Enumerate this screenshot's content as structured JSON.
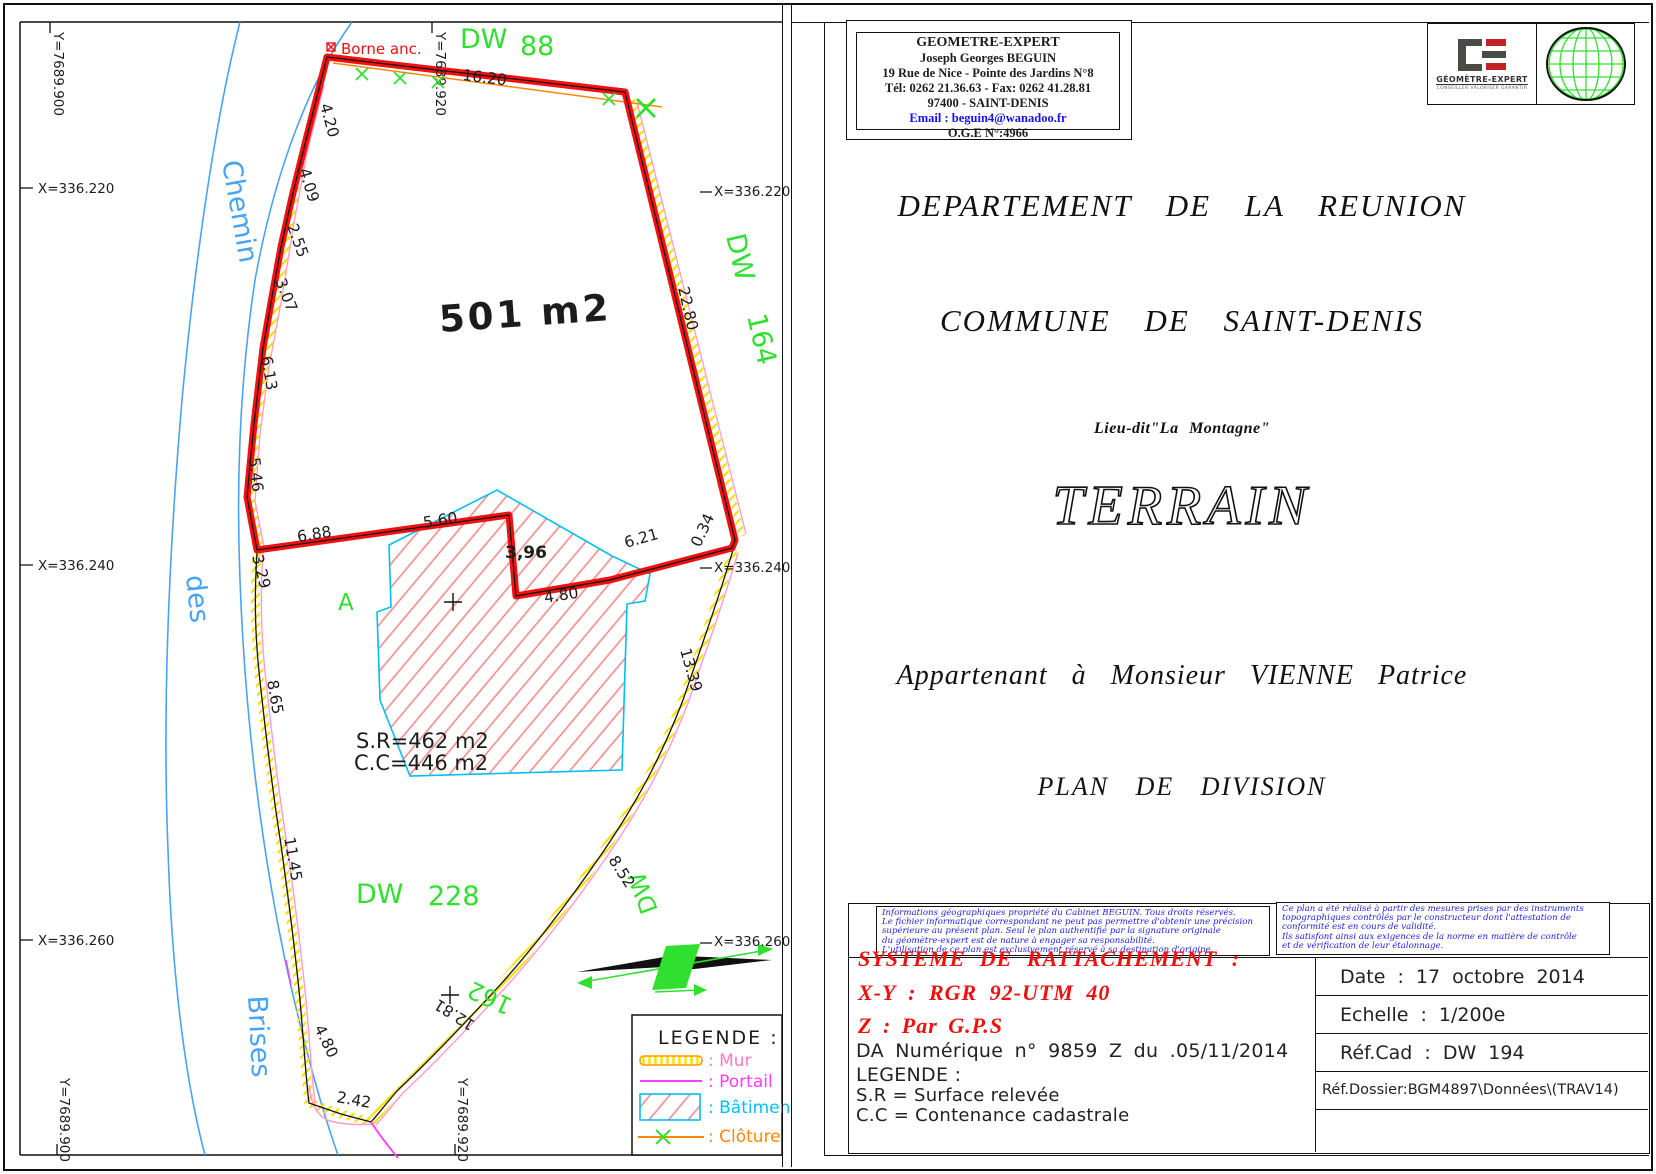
{
  "header_box": {
    "lines": [
      "GEOMETRE-EXPERT",
      "Joseph Georges BEGUIN",
      "19 Rue de Nice -  Pointe des Jardins N°8",
      "Tél: 0262 21.36.63 - Fax: 0262 41.28.81",
      "97400 - SAINT-DENIS"
    ],
    "email": "Email : beguin4@wanadoo.fr",
    "oge": "O.G.E N°:4966"
  },
  "logo": {
    "brand": "GÉOMÈTRE-EXPERT",
    "tagline": "CONSEILLER VALORISER GARANTIR"
  },
  "titles": {
    "departement": "DEPARTEMENT DE LA REUNION",
    "commune": "COMMUNE DE SAINT-DENIS",
    "lieu_dit": "Lieu-dit\"La Montagne\"",
    "terrain": "TERRAIN",
    "owner": "Appartenant à Monsieur VIENNE Patrice",
    "plan": "PLAN DE DIVISION"
  },
  "disclaimers": {
    "left": [
      "Informations géographiques propriété du Cabinet BEGUIN. Tous droits réservés.",
      "Le fichier informatique correspondant ne peut pas permettre d'obtenir une précision",
      "supérieure au présent plan. Seul le plan authentifié par la signature originale",
      "du géomètre-expert est de nature à engager sa responsabilité.",
      "L'utilisation de ce plan est exclusivement réservé à sa destination d'origine."
    ],
    "right": [
      "Ce plan a été réalisé à partir des mesures prises par des instruments",
      "topographiques contrôlés par le constructeur dont l'attestation de",
      "conformité est en cours de validité.",
      "Ils satisfont ainsi aux exigences de la norme en matière de contrôle",
      "et de vérification de leur étalonnage."
    ]
  },
  "rattachement": {
    "title": "SYSTEME DE RATTACHEMENT :",
    "xy": "X-Y : RGR 92-UTM 40",
    "z": "Z : Par G.P.S",
    "da": "DA Numérique n° 9859 Z du .05/11/2014"
  },
  "legend_block": {
    "title": "LEGENDE :",
    "sr": "S.R = Surface relevée",
    "cc": "C.C = Contenance cadastrale"
  },
  "info_table": {
    "rows": [
      "Date : 17 octobre 2014",
      "Echelle : 1/200e",
      "Réf.Cad : DW 194",
      "Réf.Dossier:BGM4897\\Données\\(TRAV14)"
    ]
  },
  "map": {
    "area_label": "501 m2",
    "sr": "S.R=462  m2",
    "cc": "C.C=446  m2",
    "borne": "Borne anc.",
    "legend": {
      "title": "LEGENDE :",
      "mur": ": Mur",
      "portail": ": Portail",
      "batiment": ": Bâtiment",
      "cloture": ": Clôture"
    },
    "stream_labels": [
      {
        "t": "Chemin",
        "x": 222,
        "y": 162,
        "r": 80
      },
      {
        "t": "des",
        "x": 186,
        "y": 576,
        "r": 84
      },
      {
        "t": "Brises",
        "x": 248,
        "y": 996,
        "r": 87
      }
    ],
    "green_labels": [
      {
        "t": "DW",
        "x": 460,
        "y": 48,
        "r": 0,
        "s": 27
      },
      {
        "t": "88",
        "x": 520,
        "y": 55,
        "r": 0,
        "s": 27
      },
      {
        "t": "DW",
        "x": 726,
        "y": 236,
        "r": 77,
        "s": 27
      },
      {
        "t": "164",
        "x": 747,
        "y": 316,
        "r": 77,
        "s": 27
      },
      {
        "t": "DW",
        "x": 356,
        "y": 903,
        "r": 0,
        "s": 27
      },
      {
        "t": "228",
        "x": 428,
        "y": 905,
        "r": 0,
        "s": 27
      },
      {
        "t": "DW",
        "x": 658,
        "y": 910,
        "r": 250,
        "s": 24
      },
      {
        "t": "162",
        "x": 514,
        "y": 1000,
        "r": 205,
        "s": 24
      },
      {
        "t": "A",
        "x": 338,
        "y": 610,
        "r": 0,
        "s": 23
      }
    ],
    "ticks": [
      {
        "t": "Y=7689.900",
        "x": 54,
        "y": 32,
        "r": 90
      },
      {
        "t": "Y=7689.920",
        "x": 436,
        "y": 32,
        "r": 90
      },
      {
        "t": "X=336.220",
        "x": 38,
        "y": 193,
        "r": 0
      },
      {
        "t": "X=336.220",
        "x": 714,
        "y": 196,
        "r": 0
      },
      {
        "t": "X=336.240",
        "x": 38,
        "y": 570,
        "r": 0
      },
      {
        "t": "X=336.240",
        "x": 714,
        "y": 572,
        "r": 0
      },
      {
        "t": "X=336.260",
        "x": 38,
        "y": 945,
        "r": 0
      },
      {
        "t": "X=336.260",
        "x": 714,
        "y": 946,
        "r": 0
      },
      {
        "t": "Y=7689.900",
        "x": 60,
        "y": 1078,
        "r": 90
      },
      {
        "t": "Y=7689.920",
        "x": 458,
        "y": 1078,
        "r": 90
      }
    ],
    "measurements": [
      {
        "t": "4.20",
        "x": 320,
        "y": 105,
        "r": 75
      },
      {
        "t": "4.09",
        "x": 299,
        "y": 170,
        "r": 73
      },
      {
        "t": "2.55",
        "x": 287,
        "y": 226,
        "r": 70
      },
      {
        "t": "3.07",
        "x": 275,
        "y": 281,
        "r": 68
      },
      {
        "t": "6.13",
        "x": 261,
        "y": 357,
        "r": 80
      },
      {
        "t": "5.46",
        "x": 249,
        "y": 458,
        "r": 84
      },
      {
        "t": "3.29",
        "x": 252,
        "y": 556,
        "r": 76
      },
      {
        "t": "8.65",
        "x": 267,
        "y": 681,
        "r": 80
      },
      {
        "t": "11.45",
        "x": 284,
        "y": 838,
        "r": 80
      },
      {
        "t": "4.80",
        "x": 314,
        "y": 1028,
        "r": 64
      },
      {
        "t": "2.42",
        "x": 336,
        "y": 1102,
        "r": 10
      },
      {
        "t": "16.20",
        "x": 462,
        "y": 80,
        "r": 7
      },
      {
        "t": "22.80",
        "x": 678,
        "y": 288,
        "r": 77
      },
      {
        "t": "6.88",
        "x": 298,
        "y": 542,
        "r": -9
      },
      {
        "t": "5.60",
        "x": 424,
        "y": 528,
        "r": -9
      },
      {
        "t": "3,96",
        "x": 505,
        "y": 558,
        "r": 0,
        "b": 1
      },
      {
        "t": "4.80",
        "x": 545,
        "y": 603,
        "r": -9
      },
      {
        "t": "6.21",
        "x": 626,
        "y": 548,
        "r": -16
      },
      {
        "t": "0.34",
        "x": 700,
        "y": 548,
        "r": -65
      },
      {
        "t": "13.39",
        "x": 680,
        "y": 650,
        "r": 74
      },
      {
        "t": "8.52",
        "x": 608,
        "y": 860,
        "r": 57
      },
      {
        "t": "12.81",
        "x": 476,
        "y": 1022,
        "r": 212
      }
    ],
    "cloture_marks": [
      {
        "x": 362,
        "y": 74
      },
      {
        "x": 400,
        "y": 78
      },
      {
        "x": 438,
        "y": 82
      },
      {
        "x": 609,
        "y": 99
      },
      {
        "x": 646,
        "y": 108,
        "s": 1.5
      }
    ]
  },
  "colors": {
    "boundary_red": "#f21010",
    "stream_blue": "#49a3f5",
    "parcel_green": "#2fe02f",
    "mur_orange": "#ff8800",
    "mur_yellow": "#ffdd00",
    "mur_pink": "#ff9ad5",
    "portail_magenta": "#ff3df7",
    "batiment_cyan": "#00c0f0",
    "batiment_hatch": "#f29090",
    "note_blue": "#1d1df0",
    "text_red": "#f01010"
  }
}
